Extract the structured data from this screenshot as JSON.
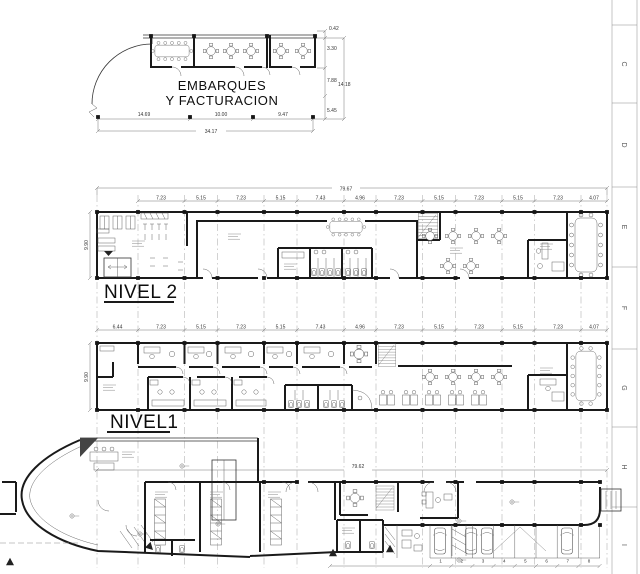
{
  "sheet": {
    "letters": [
      "C",
      "D",
      "E",
      "F",
      "G",
      "H",
      "I"
    ]
  },
  "embarques": {
    "title_line1": "EMBARQUES",
    "title_line2": "Y FACTURACION",
    "dims_bottom": [
      "14.69",
      "10.00",
      "9.47"
    ],
    "dim_total": "34.17",
    "dims_right": [
      "0.42",
      "3.30",
      "7.88",
      "14.18",
      "5.45"
    ]
  },
  "nivel2": {
    "name": "NIVEL 2",
    "dim_total": "79.67",
    "dim_left": "9.90",
    "col_dims": [
      "7.23",
      "5.15",
      "7.23",
      "5.15",
      "7.43",
      "4.96",
      "7.23",
      "5.15",
      "7.23",
      "5.15",
      "7.23",
      "4.07"
    ]
  },
  "nivel1": {
    "name": "NIVEL1",
    "dim_left": "9.90",
    "col_dims": [
      "6.44",
      "7.23",
      "5.15",
      "7.23",
      "5.15",
      "7.43",
      "4.96",
      "7.23",
      "5.15",
      "7.23",
      "5.15",
      "7.23",
      "4.07"
    ]
  },
  "ground": {
    "dim_total": "79.62",
    "stall_numbers": [
      "1",
      "2",
      "3",
      "4",
      "5",
      "6",
      "7",
      "8"
    ]
  }
}
